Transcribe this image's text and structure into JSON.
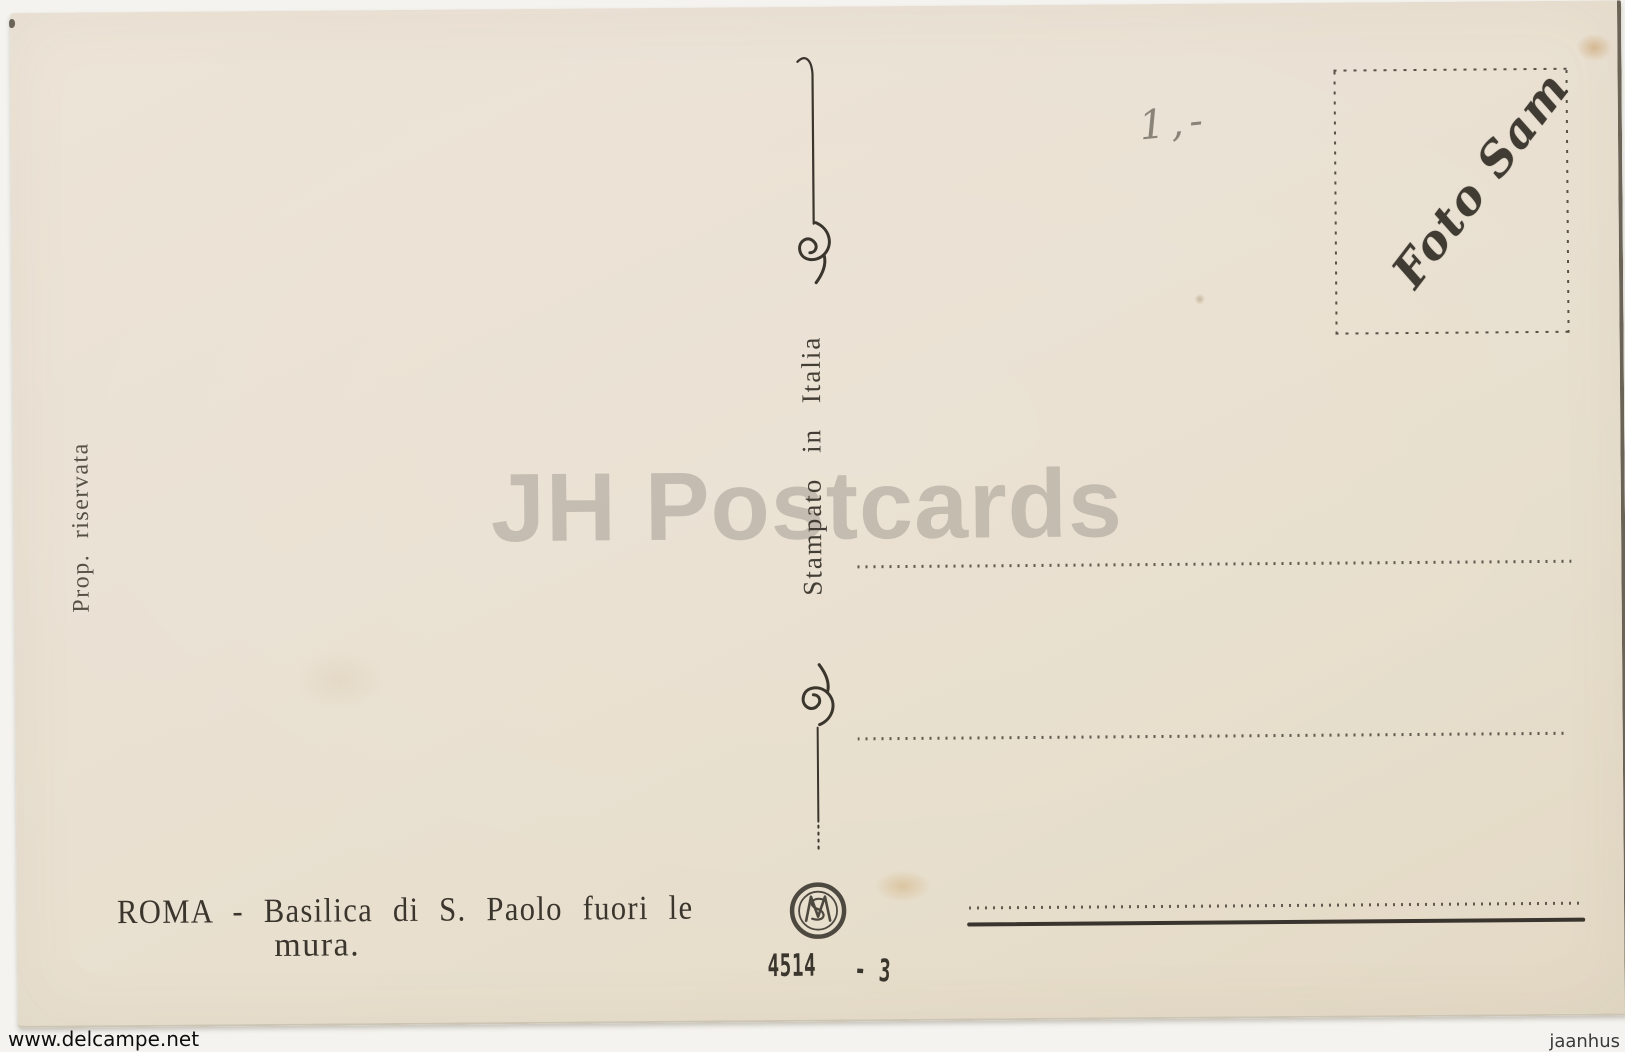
{
  "page": {
    "watermark_center": "JH Postcards",
    "source_bottom_left": "www.delcampe.net",
    "source_bottom_right": "jaanhus"
  },
  "card": {
    "left_margin_text": "Prop. riservata",
    "divider_text": "Stampato in Italia",
    "stamp_box": {
      "signature": "Foto Sam"
    },
    "handwritten_price": "1,-",
    "caption": {
      "line1": "ROMA - Basilica di S. Paolo fuori le",
      "line2": "mura."
    },
    "serial": {
      "number": "4514",
      "suffix": "- 3"
    }
  },
  "colors": {
    "paper": "#e9e0d0",
    "ink": "#3b362e",
    "pencil": "#8a8478",
    "watermark_gray": "#c3bfb4",
    "scan_background": "#f4f3ef",
    "stain": "#b87a2d"
  }
}
